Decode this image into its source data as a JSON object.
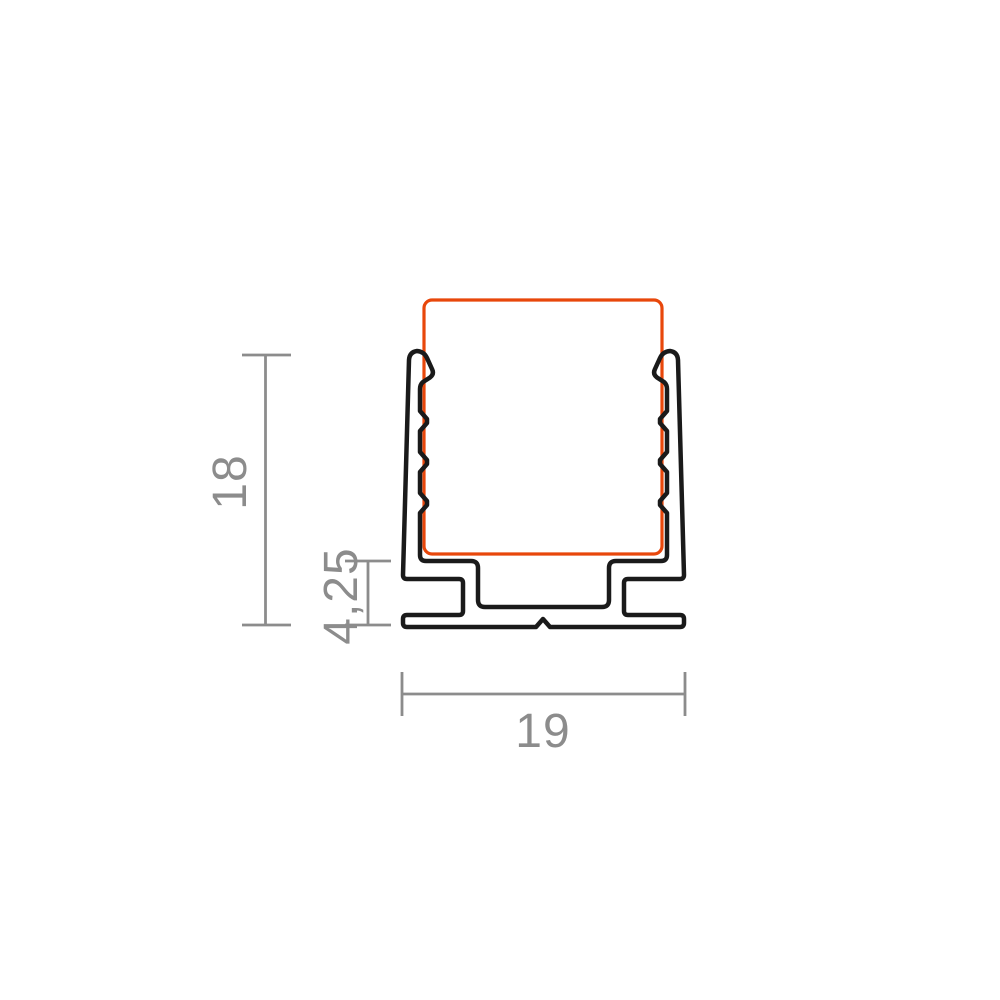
{
  "drawing": {
    "kind": "profile-cross-section-technical-drawing",
    "dimensions": {
      "height": {
        "label": "18"
      },
      "base_height": {
        "label": "4,25"
      },
      "width": {
        "label": "19"
      }
    },
    "colors": {
      "outline": "#1A1A1A",
      "highlight": "#E8470B",
      "dimension": "#8C8C8C",
      "background": "#FFFFFF"
    }
  }
}
